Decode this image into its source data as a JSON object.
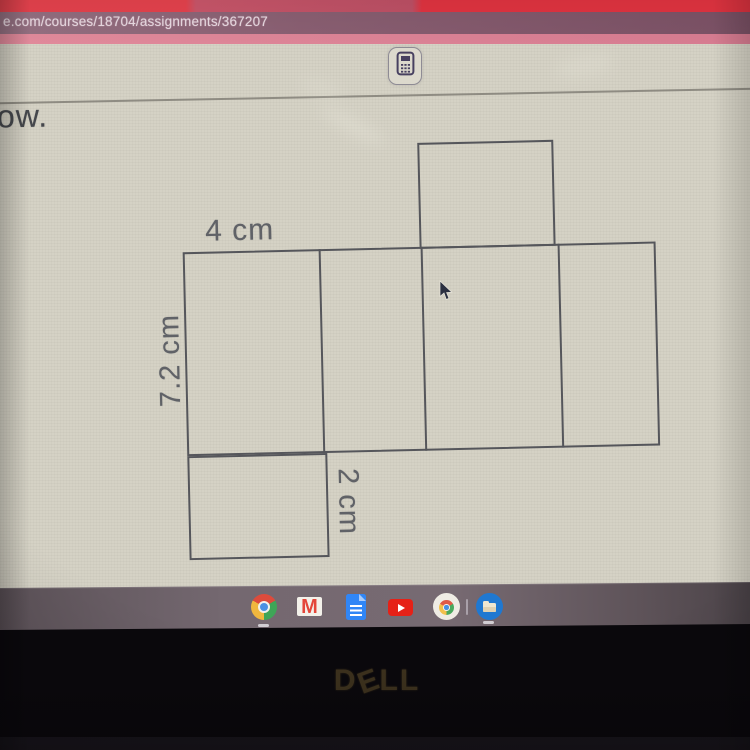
{
  "browser": {
    "url": "e.com/courses/18704/assignments/367207"
  },
  "toolbar": {
    "calculator_button": "calculator"
  },
  "page": {
    "question_text_partial": "ow."
  },
  "figure": {
    "type": "net-of-rectangular-prism",
    "dimension_labels": {
      "width": "4 cm",
      "height": "7.2 cm",
      "depth": "2 cm"
    }
  },
  "shelf": {
    "gmail_letter": "M",
    "icons": [
      "chrome",
      "gmail",
      "google-docs",
      "youtube",
      "chrome-app",
      "files"
    ]
  },
  "laptop": {
    "brand": "DELL",
    "brand_letters": {
      "d": "D",
      "e": "E",
      "ll": "LL"
    }
  },
  "colors": {
    "tab_strip_red": "#e03a46",
    "url_bar_mauve": "#8a5f72",
    "pink_strip": "#dd7f92",
    "content_cream": "#d5d2c5",
    "shelf_gray": "#6e6168",
    "figure_line": "#55565b",
    "youtube_red": "#e62117",
    "docs_blue": "#3086f6",
    "files_blue": "#1f78d1"
  }
}
